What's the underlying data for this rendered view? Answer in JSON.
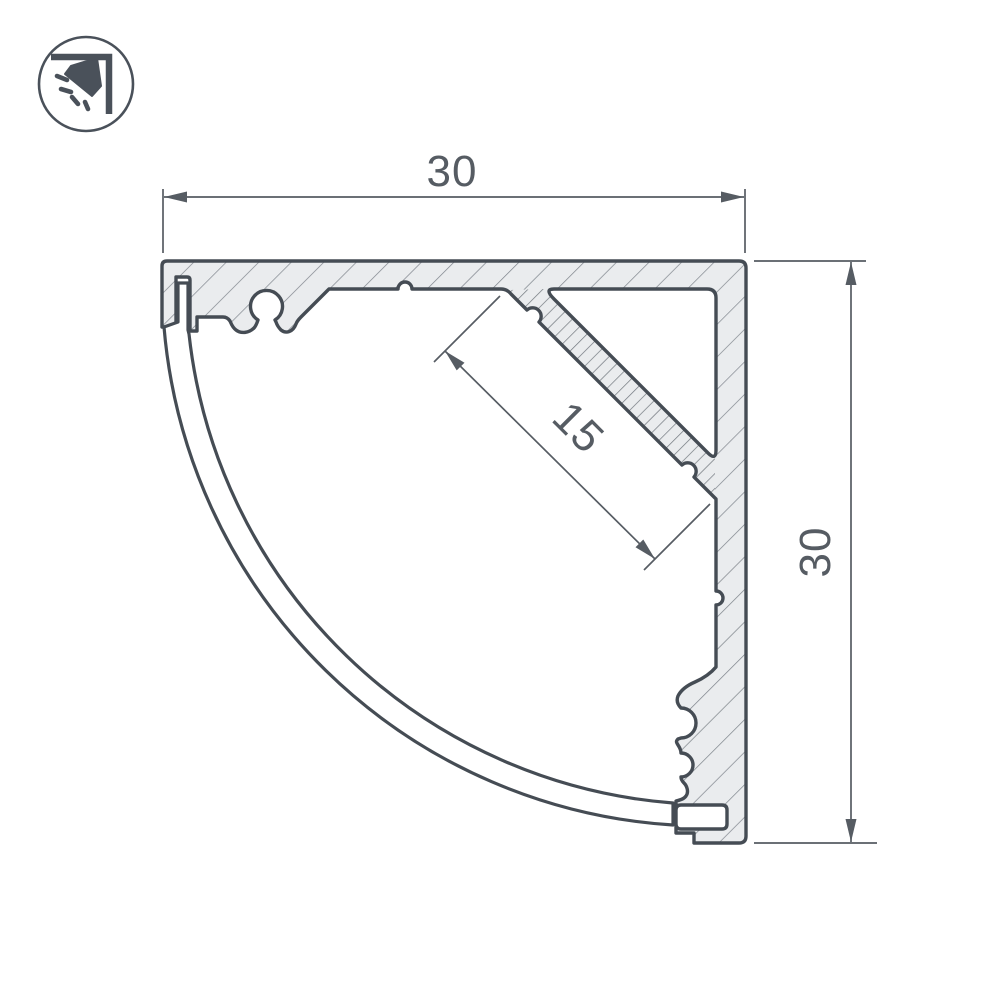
{
  "page": {
    "background": "#ffffff"
  },
  "logo": {
    "icon": "corner-downlight-icon"
  },
  "drawing": {
    "kind": "technical cross-section of corner LED aluminium profile with round diffuser cover",
    "dimensions": {
      "width_top": {
        "label": "30"
      },
      "height_right": {
        "label": "30"
      },
      "led_platform": {
        "label": "15"
      }
    },
    "colors": {
      "outline": "#454c54",
      "hatch": "#7e848b",
      "body_fill": "#eaecee",
      "dimension": "#565c63"
    }
  }
}
